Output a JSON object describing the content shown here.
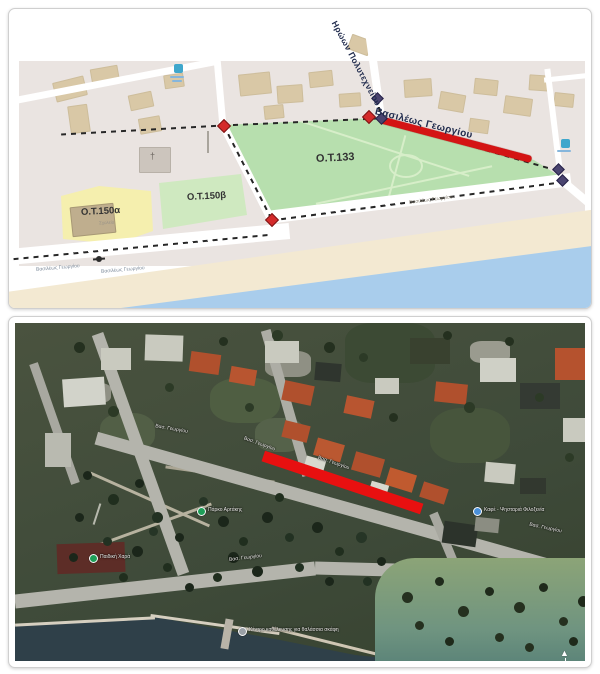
{
  "top_map": {
    "street_diagonal": "Ηρώων Πολυτεχνείου",
    "street_highlighted": "Βασιλέως Γεωργίου",
    "street_coastal_a": "Βασιλέως Γεωργίου",
    "street_coastal_b": "Βασιλέως Γεωργίου",
    "street_right_small": "Βασιλέως Γεωργίου",
    "block_park_label": "Ο.Τ.133",
    "block_150a_label": "Ο.Τ.150α",
    "block_150a_sublabel": "Σχολείο",
    "block_150b_label": "Ο.Τ.150β",
    "church_symbol": "†",
    "colors": {
      "park": "#b7dfae",
      "block_yellow": "#f5efae",
      "block_green": "#cfe9c0",
      "buildings": "#d9c8a6",
      "urban": "#eae4e1",
      "sand": "#f3e9d2",
      "sea": "#a9cdec",
      "highlight": "#d41414",
      "marker_red": "#d42a2a",
      "marker_purple": "#4a4470"
    }
  },
  "satellite_map": {
    "street_labels": [
      {
        "text": "Βασ. Γεωργίου"
      },
      {
        "text": "Βασ. Γεωργίου"
      },
      {
        "text": "Βασ. Γεωργίου"
      },
      {
        "text": "Βασ. Γεωργίου"
      },
      {
        "text": "Βασ. Γεωργίου"
      }
    ],
    "pois": [
      {
        "label": "Πάρκο Αρτάκης"
      },
      {
        "label": "Παιδική Χαρά"
      },
      {
        "label": "Καφέ - Ψησταριά Φιλοξενία"
      },
      {
        "label": "Κέντρο καθέλκυσης για θαλάσσια σκάφη"
      }
    ],
    "north_arrow": "▲",
    "colors": {
      "highlight": "#e81010",
      "sea": "#2f4049",
      "field": "#8ca477"
    }
  }
}
